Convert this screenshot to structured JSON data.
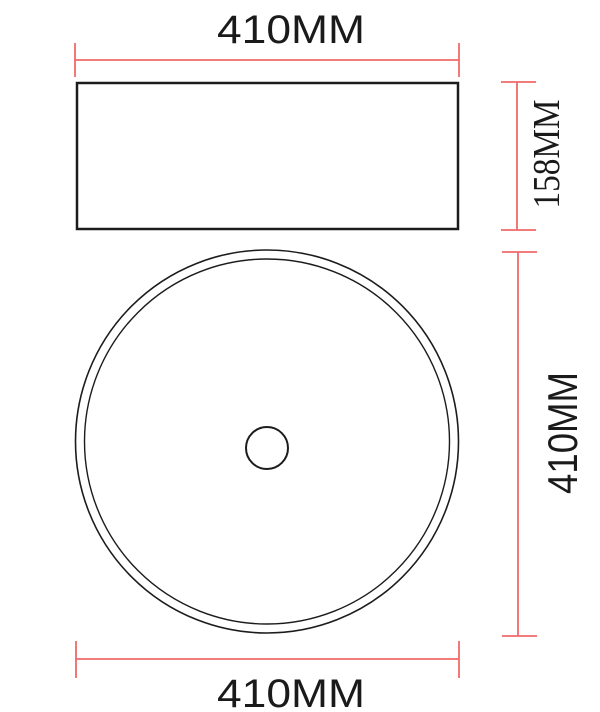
{
  "drawing": {
    "labels": {
      "top_width": "410MM",
      "side_height": "158MM",
      "plan_diameter": "410MM",
      "bottom_width": "410MM"
    },
    "colors": {
      "dimension": "#f1696a",
      "outline": "#1c1c1c",
      "text": "#1a1a1a"
    }
  }
}
